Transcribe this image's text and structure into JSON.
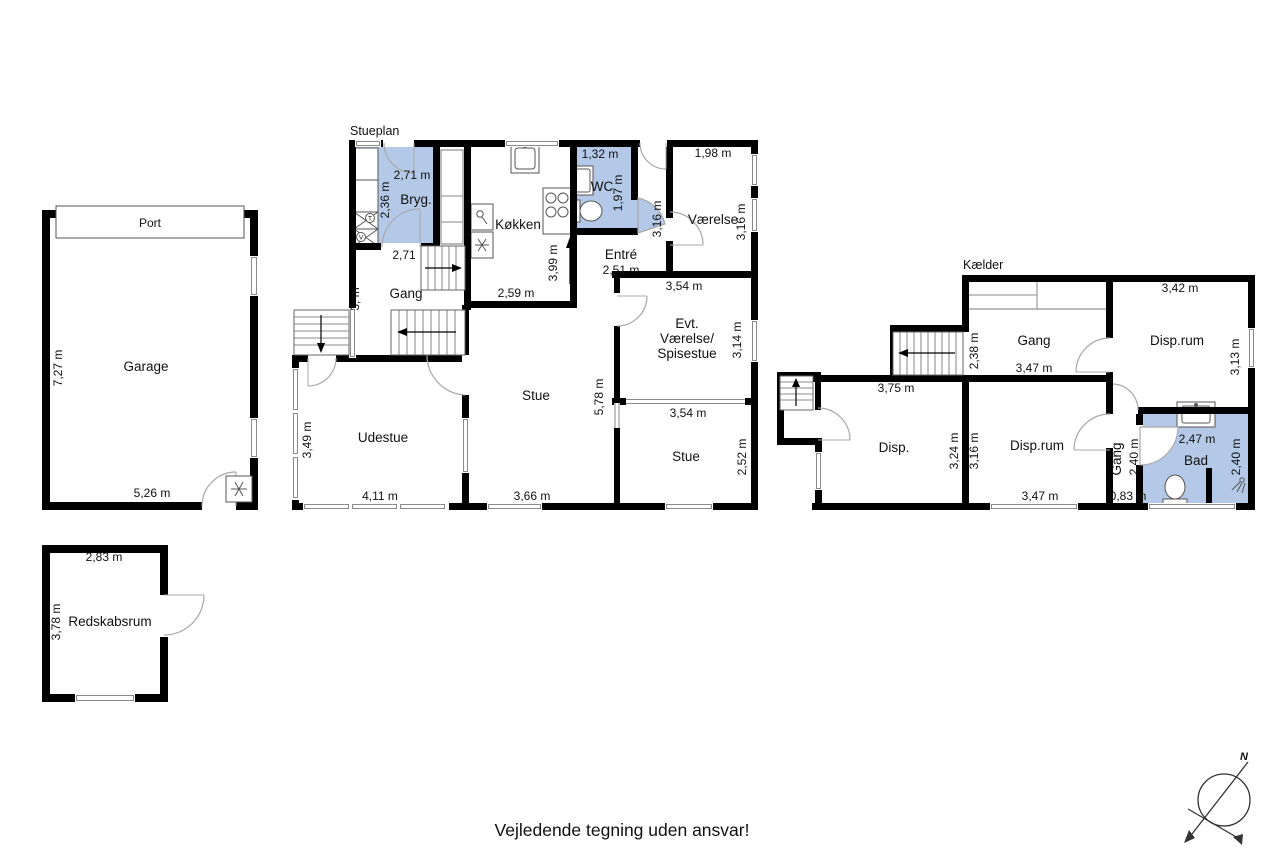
{
  "titles": {
    "stueplan": "Stueplan",
    "kaelder": "Kælder"
  },
  "footer": {
    "disclaimer": "Vejledende tegning uden ansvar!"
  },
  "compass": {
    "north": "N"
  },
  "garage": {
    "port": "Port",
    "name": "Garage",
    "height_dim": "7,27 m",
    "width_dim": "5,26 m"
  },
  "redskabsrum": {
    "name": "Redskabsrum",
    "width_dim": "2,83 m",
    "height_dim": "3,78 m"
  },
  "stueplan": {
    "bryg": {
      "name": "Bryg.",
      "width_dim": "2,71 m",
      "height_dim": "2,36 m",
      "width_dim2": "2,71"
    },
    "gang": {
      "name": "Gang",
      "height_dim_partial": "3, m"
    },
    "koekken": {
      "name": "Køkken",
      "width_dim": "2,59 m",
      "height_dim": "3,99 m"
    },
    "wc": {
      "name": "WC",
      "width_dim": "1,32 m",
      "height_dim": "1,97 m"
    },
    "entre": {
      "name": "Entré",
      "width_dim": "2,51 m",
      "height_dim": "3,16 m"
    },
    "vaerelse": {
      "name": "Værelse",
      "width_dim": "1,98 m",
      "height_dim": "3,16 m",
      "bottom_dim": "3,54 m"
    },
    "spisestue": {
      "line1": "Evt.",
      "line2": "Værelse/",
      "line3": "Spisestue",
      "height_dim": "3,14 m",
      "bottom_dim": "3,54 m"
    },
    "stue": {
      "name": "Stue",
      "height_dim": "5,78 m",
      "width_dim": "3,66 m"
    },
    "stue2": {
      "name": "Stue",
      "height_dim": "2,52 m"
    },
    "udestue": {
      "name": "Udestue",
      "width_dim": "4,11 m",
      "height_dim": "3,49 m"
    },
    "appliances": {
      "washer": "T",
      "dryer": "V"
    }
  },
  "kaelder": {
    "gang": {
      "name": "Gang",
      "height_dim": "2,38 m",
      "width_dim": "3,47 m"
    },
    "disprum1": {
      "name": "Disp.rum",
      "width_dim": "3,42 m",
      "height_dim": "3,13 m"
    },
    "disp": {
      "name": "Disp.",
      "width_dim": "3,75 m",
      "height_dim": "3,24 m"
    },
    "disprum2": {
      "name": "Disp.rum",
      "width_dim": "3,47 m",
      "height_dim": "3,16 m"
    },
    "gang2": {
      "name": "Gang",
      "height_dim": "2,40 m",
      "width_dim": "0,83 m"
    },
    "bad": {
      "name": "Bad",
      "width_dim": "2,47 m",
      "height_dim": "2,40 m"
    }
  },
  "colors": {
    "highlight": "#b4c9e8",
    "wall": "#000000",
    "background": "#ffffff"
  }
}
